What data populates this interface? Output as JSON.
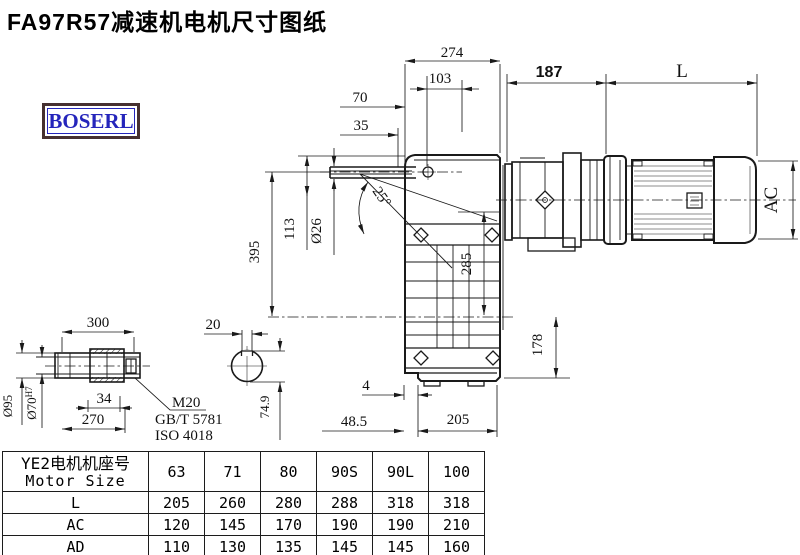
{
  "title": "FA97R57减速机电机尺寸图纸",
  "logo": "BOSERL",
  "drawing": {
    "top_dims": {
      "d274": "274",
      "d103": "103",
      "d70": "70",
      "d35": "35",
      "d187": "187",
      "dL": "L"
    },
    "left_dims": {
      "d395": "395",
      "d113": "113",
      "d26": "Ø26",
      "angle": "25°"
    },
    "right_dims": {
      "d285": "285",
      "d178": "178",
      "dAC": "AC"
    },
    "bottom_dims": {
      "d4": "4",
      "d48_5": "48.5",
      "d205": "205"
    },
    "shaft_detail": {
      "d300": "300",
      "d270": "270",
      "d34": "34",
      "d95": "Ø95",
      "d70h7_base": "Ø70",
      "d70h7_sup": "H7",
      "leader_line1": "M20",
      "leader_line2": "GB/T 5781",
      "leader_line3": "ISO 4018"
    },
    "section_detail": {
      "d20": "20",
      "d74_9": "74.9"
    }
  },
  "table": {
    "header_col": {
      "line1": "YE2电机机座号",
      "line2": "Motor Size"
    },
    "columns": [
      "63",
      "71",
      "80",
      "90S",
      "90L",
      "100"
    ],
    "rows": [
      {
        "label": "L",
        "values": [
          "205",
          "260",
          "280",
          "288",
          "318",
          "318"
        ]
      },
      {
        "label": "AC",
        "values": [
          "120",
          "145",
          "170",
          "190",
          "190",
          "210"
        ]
      },
      {
        "label": "AD",
        "values": [
          "110",
          "130",
          "135",
          "145",
          "145",
          "160"
        ]
      }
    ]
  }
}
